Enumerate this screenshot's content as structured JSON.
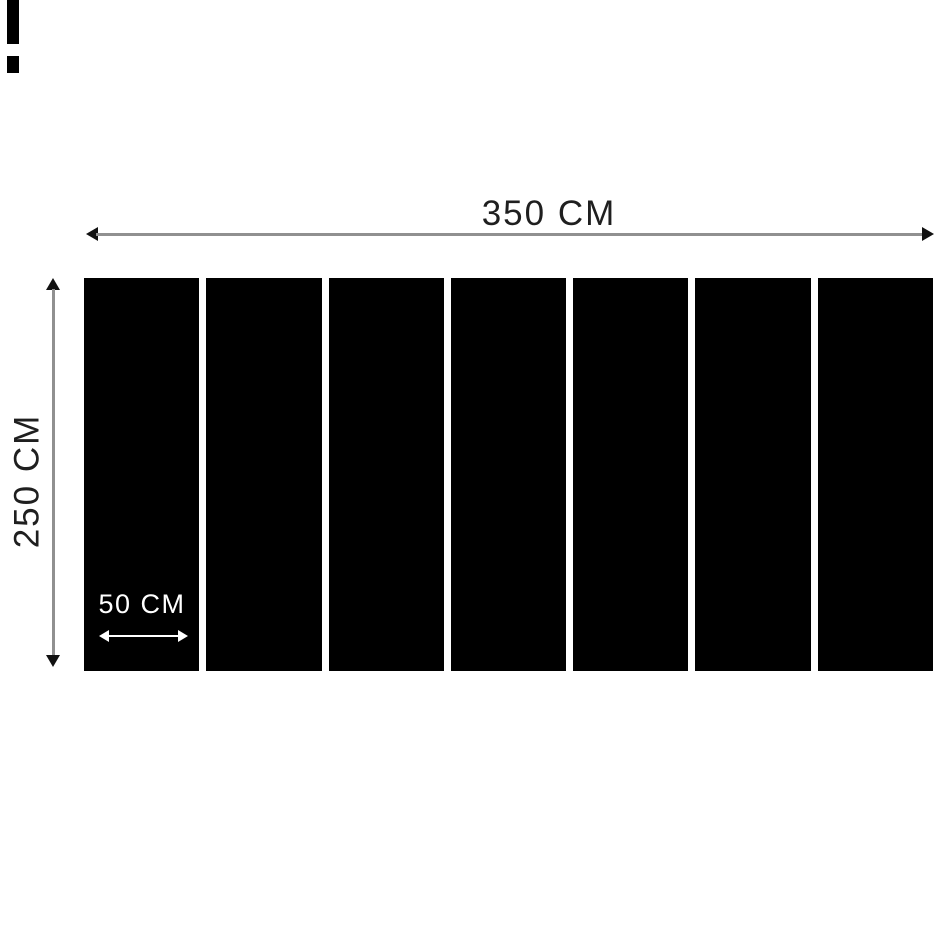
{
  "diagram": {
    "total_width": {
      "label": "350 CM",
      "value_cm": 350
    },
    "total_height": {
      "label": "250 CM",
      "value_cm": 250
    },
    "panel_width": {
      "label": "50 CM",
      "value_cm": 50
    },
    "panel_count": 7,
    "colors": {
      "background": "#ffffff",
      "panel": "#000000",
      "arrow_line": "#909090",
      "arrowhead": "#111111",
      "text": "#1f1f1f",
      "panel_text": "#ffffff"
    }
  }
}
